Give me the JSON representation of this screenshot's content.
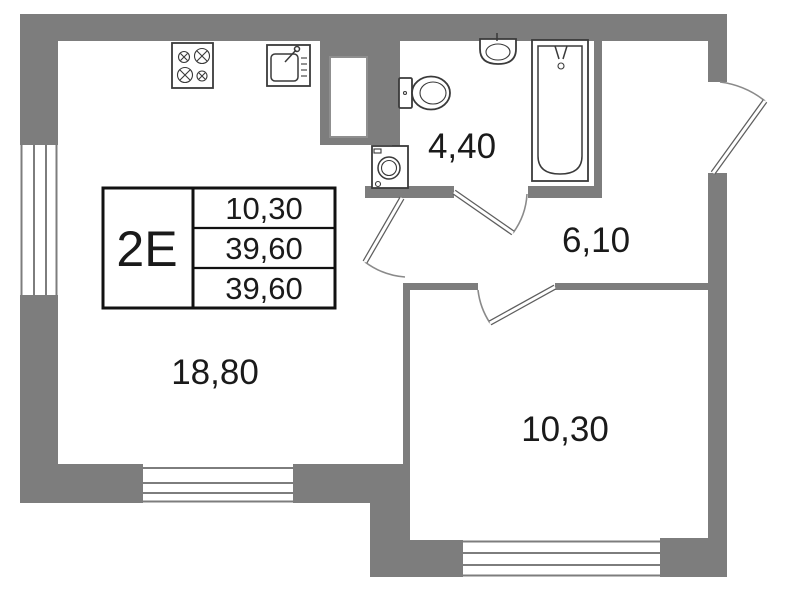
{
  "colors": {
    "background": "#ffffff",
    "wall": "#7d7d7d",
    "line": "#3a3a3a",
    "text": "#1a1a1a"
  },
  "info_table": {
    "unit_label": "2E",
    "rows": [
      "10,30",
      "39,60",
      "39,60"
    ]
  },
  "rooms": {
    "living": {
      "name": "living-kitchen",
      "area": "18,80"
    },
    "bathroom": {
      "name": "bathroom",
      "area": "4,40"
    },
    "hallway": {
      "name": "hallway",
      "area": "6,10"
    },
    "bedroom": {
      "name": "bedroom",
      "area": "10,30"
    }
  },
  "fixtures": [
    "stove-icon",
    "kitchen-sink-icon",
    "ventilation-shaft",
    "washing-machine-icon",
    "toilet-icon",
    "wash-basin-icon",
    "bathtub-icon"
  ],
  "openings": {
    "doors": [
      "entrance-door",
      "bathroom-door",
      "living-room-door",
      "bedroom-door"
    ],
    "windows": [
      "window-left",
      "window-living-south",
      "window-bedroom-south"
    ]
  }
}
